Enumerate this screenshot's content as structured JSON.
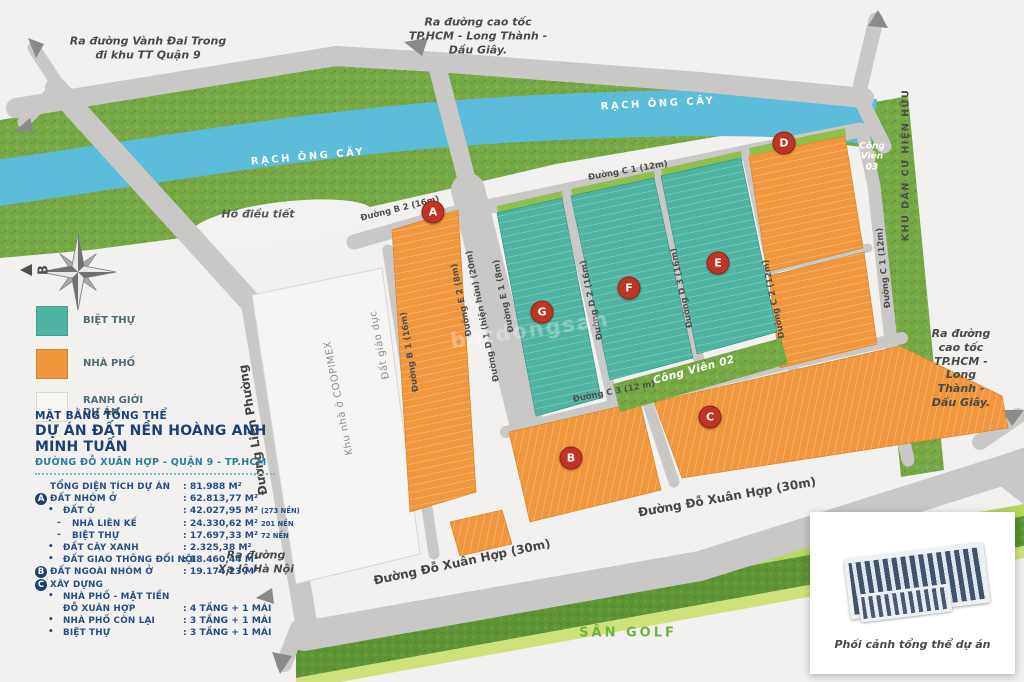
{
  "map": {
    "colors": {
      "villa_teal": "#4fb4a1",
      "townhouse_orange": "#f0973e",
      "river_blue": "#5cbcd9",
      "grass_green": "#76a845",
      "road_gray": "#c9c8c6",
      "marker_red": "#bf3423"
    },
    "markers": [
      {
        "letter": "A",
        "x": 433,
        "y": 212
      },
      {
        "letter": "B",
        "x": 571,
        "y": 458
      },
      {
        "letter": "C",
        "x": 710,
        "y": 417
      },
      {
        "letter": "D",
        "x": 784,
        "y": 143
      },
      {
        "letter": "E",
        "x": 718,
        "y": 263
      },
      {
        "letter": "F",
        "x": 629,
        "y": 288
      },
      {
        "letter": "G",
        "x": 542,
        "y": 312
      }
    ],
    "labels": [
      {
        "name": "label-vanh-dai-trong",
        "text": "Ra đường Vành Đai Trong\nđi khu TT Quận 9",
        "x": 148,
        "y": 48,
        "rot": 0,
        "cls": "outside"
      },
      {
        "name": "label-cao-toc-top",
        "text": "Ra đường cao tốc\nTP.HCM - Long Thành -\nDầu Giây.",
        "x": 478,
        "y": 36,
        "rot": 0,
        "cls": "outside"
      },
      {
        "name": "label-cao-toc-right",
        "text": "Ra đường cao tốc\nTP.HCM - Long Thành -\nDầu Giây.",
        "x": 961,
        "y": 368,
        "rot": 0,
        "cls": "outside"
      },
      {
        "name": "label-xa-lo-ha-noi",
        "text": "Ra đường\nXa lộ Hà Nội",
        "x": 256,
        "y": 562,
        "rot": 0,
        "cls": "outside"
      },
      {
        "name": "label-rach-ong-cay-left",
        "text": "RẠCH ÔNG CÂY",
        "x": 308,
        "y": 157,
        "rot": -5,
        "cls": "river"
      },
      {
        "name": "label-rach-ong-cay-right",
        "text": "RẠCH ÔNG CÂY",
        "x": 658,
        "y": 104,
        "rot": -3,
        "cls": "river"
      },
      {
        "name": "label-ho-dieu-tiet",
        "text": "Hồ điều tiết",
        "x": 258,
        "y": 214,
        "rot": 0,
        "cls": "ho"
      },
      {
        "name": "label-khu-dan-cu-hien-huu",
        "text": "KHU DÂN CƯ HIỆN HỮU",
        "x": 906,
        "y": 165,
        "rot": -90,
        "cls": "kdc"
      },
      {
        "name": "label-cong-vien-03",
        "text": "Công\nViên\n03",
        "x": 872,
        "y": 157,
        "rot": 0,
        "cls": "park"
      },
      {
        "name": "label-cong-vien-02",
        "text": "Công Viên 02",
        "x": 694,
        "y": 370,
        "rot": -15,
        "cls": "park2"
      },
      {
        "name": "label-san-golf",
        "text": "SÂN GOLF",
        "x": 628,
        "y": 633,
        "rot": 0,
        "cls": "golf"
      },
      {
        "name": "road-b2",
        "text": "Đường B 2 (16m)",
        "x": 400,
        "y": 209,
        "rot": -14,
        "cls": "road"
      },
      {
        "name": "road-c1-top",
        "text": "Đường C 1 (12m)",
        "x": 628,
        "y": 171,
        "rot": -10,
        "cls": "road"
      },
      {
        "name": "road-c3",
        "text": "Đường C 3 (12 m)",
        "x": 614,
        "y": 392,
        "rot": -11,
        "cls": "road"
      },
      {
        "name": "road-b1",
        "text": "Đường B 1 (16m)",
        "x": 410,
        "y": 352,
        "rot": -99,
        "cls": "road"
      },
      {
        "name": "road-e2",
        "text": "Đường E 2 (8m)",
        "x": 462,
        "y": 300,
        "rot": -102,
        "cls": "road"
      },
      {
        "name": "road-d1",
        "text": "Đường D 1 (hiện hữu) (20m)",
        "x": 483,
        "y": 316,
        "rot": -102,
        "cls": "road"
      },
      {
        "name": "road-e1",
        "text": "Đường E 1 (8m)",
        "x": 504,
        "y": 296,
        "rot": -102,
        "cls": "road"
      },
      {
        "name": "road-d2",
        "text": "Đường D 2 (16m)",
        "x": 592,
        "y": 300,
        "rot": -102,
        "cls": "road"
      },
      {
        "name": "road-d3",
        "text": "Đường D 3 (16m)",
        "x": 682,
        "y": 288,
        "rot": -102,
        "cls": "road"
      },
      {
        "name": "road-c2",
        "text": "Đường C 2 (12m)",
        "x": 774,
        "y": 299,
        "rot": -102,
        "cls": "road"
      },
      {
        "name": "road-c1-right",
        "text": "Đường C 1 (12m)",
        "x": 884,
        "y": 268,
        "rot": -96,
        "cls": "road"
      },
      {
        "name": "road-do-xuan-hop-right",
        "text": "Đường Đỗ Xuân Hợp (30m)",
        "x": 727,
        "y": 497,
        "rot": -10,
        "cls": "roadbig"
      },
      {
        "name": "road-do-xuan-hop-left",
        "text": "Đường Đỗ Xuân Hợp (30m)",
        "x": 462,
        "y": 562,
        "rot": -12,
        "cls": "roadbig"
      },
      {
        "name": "road-lien-phuong",
        "text": "Đường Liên Phường",
        "x": 253,
        "y": 430,
        "rot": -99,
        "cls": "roadbig"
      },
      {
        "name": "area-coopimex",
        "text": "Khu nhà ở COOPIMEX",
        "x": 339,
        "y": 398,
        "rot": -101,
        "cls": "area"
      },
      {
        "name": "area-dat-giao-duc",
        "text": "Đất giáo dục",
        "x": 380,
        "y": 345,
        "rot": -101,
        "cls": "area"
      },
      {
        "name": "compass-north-letter",
        "text": "B",
        "x": 44,
        "y": 270,
        "rot": -90,
        "cls": "compassB"
      }
    ]
  },
  "legend": {
    "items": [
      {
        "label": "BIỆT THỰ",
        "color": "#4fb4a1"
      },
      {
        "label": "NHÀ PHỐ",
        "color": "#f0973e"
      },
      {
        "label": "RANH GIỚI\nDỰ ÁN",
        "color": "#f7f6f3"
      }
    ]
  },
  "info_panel": {
    "heading_small": "MẶT BẰNG TỔNG THỂ",
    "heading_large": "DỰ ÁN ĐẤT NỀN HOÀNG ANH MINH TUẤN",
    "address": "ĐƯỜNG ĐỖ XUÂN HỢP - QUẬN 9 - TP.HCM",
    "rows": [
      {
        "marker": "",
        "indent": 0,
        "label": "TỔNG DIỆN TÍCH DỰ ÁN",
        "value": ": 81.988 M²",
        "note": ""
      },
      {
        "marker": "A",
        "indent": 0,
        "label": "ĐẤT NHÓM Ở",
        "value": ": 62.813,77 M²",
        "note": ""
      },
      {
        "marker": "•",
        "indent": 1,
        "label": "ĐẤT Ở",
        "value": ": 42.027,95 M²",
        "note": "(273 NỀN)"
      },
      {
        "marker": "-",
        "indent": 2,
        "label": "NHÀ LIÊN KẾ",
        "value": ": 24.330,62 M²",
        "note": "201 NỀN"
      },
      {
        "marker": "-",
        "indent": 2,
        "label": "BIỆT THỰ",
        "value": ": 17.697,33 M²",
        "note": "72 NỀN"
      },
      {
        "marker": "•",
        "indent": 1,
        "label": "ĐẤT CÂY XANH",
        "value": ": 2.325,38 M²",
        "note": ""
      },
      {
        "marker": "•",
        "indent": 1,
        "label": "ĐẤT GIAO THÔNG ĐỐI NỘI",
        "value": ": 18.460,44 M²",
        "note": ""
      },
      {
        "marker": "B",
        "indent": 0,
        "label": "ĐẤT NGOÀI NHÓM Ở",
        "value": ": 19.174,23 M²",
        "note": ""
      },
      {
        "marker": "C",
        "indent": 0,
        "label": "XÂY DỰNG",
        "value": "",
        "note": ""
      },
      {
        "marker": "•",
        "indent": 1,
        "label": "NHÀ PHỐ - MẶT TIỀN",
        "value": "",
        "note": ""
      },
      {
        "marker": "",
        "indent": 1,
        "label": "ĐỖ XUÂN HỢP",
        "value": ": 4 TẦNG + 1 MÁI",
        "note": ""
      },
      {
        "marker": "•",
        "indent": 1,
        "label": "NHÀ PHỐ CÒN LẠI",
        "value": ": 3 TẦNG + 1 MÁI",
        "note": ""
      },
      {
        "marker": "•",
        "indent": 1,
        "label": "BIỆT THỰ",
        "value": ": 3 TẦNG + 1 MÁI",
        "note": ""
      }
    ]
  },
  "inset": {
    "caption": "Phối cảnh tổng thể dự án"
  },
  "watermark": "batdongsan"
}
